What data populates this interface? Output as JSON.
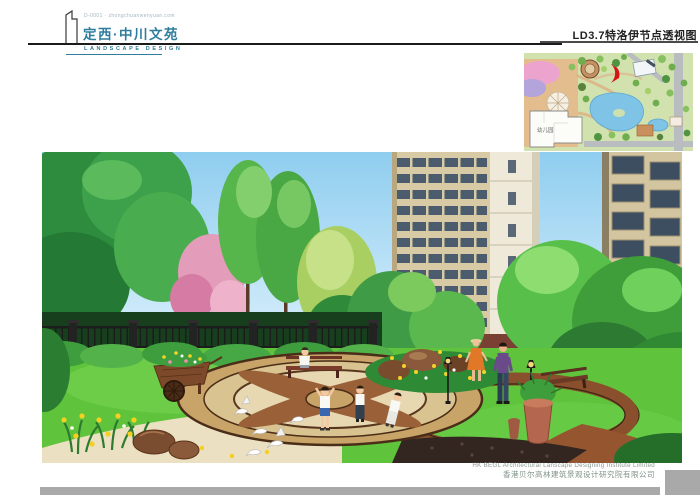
{
  "header": {
    "tagline": "D-0001 · zhongchuanwenyuan.com",
    "project_name": "定西·中川文苑",
    "discipline": "LANDSCAPE DESIGN",
    "sheet_title": "LD3.7特洛伊节点透视图",
    "accent_color": "#2e7d9c"
  },
  "inset_plan": {
    "kindergarten_label": "幼儿园",
    "marker_color": "#d41616",
    "pond_color": "#7fc3e6"
  },
  "footer": {
    "company_en": "HK BEGL Architectural Lanscape Designing Institute Limited",
    "company_cn": "香港贝尔高林建筑景观设计研究院有限公司",
    "bar_color": "#a9a9a9"
  }
}
